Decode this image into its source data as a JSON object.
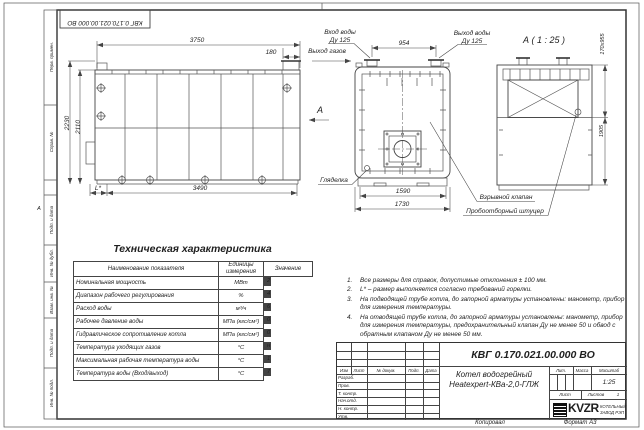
{
  "doc": {
    "number": "КВГ 0.170.021.00.000 ВО",
    "number_top": "КВГ 0.170.021.00.000 ВО",
    "name_line1": "Котел водогрейный",
    "name_line2": "Heatexpert-КВа-2,0-ГЛЖ",
    "scale_value": "1:25",
    "sheets_value": "1",
    "copied_label": "Копировал",
    "format_label": "Формат А3"
  },
  "frame": {
    "zone": "А",
    "left_labels": [
      "Перв. примен.",
      "Справ. №",
      "Подп. и дата",
      "Инв. № дубл.",
      "Взам. инв. №",
      "Подп. и дата",
      "Инв. № подл."
    ]
  },
  "views": {
    "view_arrow": "А",
    "side": {
      "dims": {
        "top": "3750",
        "offset": "180",
        "h1": "2230",
        "h2": "2110",
        "bottom": "3490",
        "l": "L*"
      }
    },
    "front": {
      "dims": {
        "nozzles": "954",
        "base": "1590",
        "full": "1730"
      },
      "labels": {
        "in1": "Вход воды",
        "in2": "Ду 125",
        "out1": "Выход воды",
        "out2": "Ду 125",
        "gas": "Выход газов",
        "sight": "Гляделка",
        "valve": "Взрывной клапан",
        "sampler": "Пробоотборный штуцер"
      }
    },
    "section": {
      "title": "А ( 1 : 25 )",
      "dims": {
        "opening": "170х955",
        "height": "1905"
      }
    }
  },
  "table": {
    "title": "Техническая характеристика",
    "headers": [
      "Наименование показателя",
      "Единицы измерения",
      "Значение"
    ],
    "rows": [
      {
        "name": "Номинальная мощность",
        "unit": "МВт",
        "value": "2,0"
      },
      {
        "name": "Диапазон рабочего регулирования",
        "unit": "%",
        "value": "40-100"
      },
      {
        "name": "Расход воды",
        "unit": "м³/ч",
        "value": "68"
      },
      {
        "name": "Рабочее давление воды",
        "unit": "МПа (кгс/см²)",
        "value": "0,3(3,0)-0,6(6,0)"
      },
      {
        "name": "Гидравлическое сопротивление котла",
        "unit": "МПа (кгс/см²)",
        "value": "0,07(0,7)"
      },
      {
        "name": "Температура уходящих газов",
        "unit": "°С",
        "value": "не более 220"
      },
      {
        "name": "Максимальная рабочая температура воды",
        "unit": "°С",
        "value": "115"
      },
      {
        "name": "Температура воды (Вход/выход)",
        "unit": "°С",
        "value": "70/95"
      }
    ]
  },
  "notes": {
    "items": [
      {
        "num": "1.",
        "text": "Все размеры для справок, допустимые отклонения ± 100 мм."
      },
      {
        "num": "2.",
        "text": "L* – размер выполняется согласно требований горелки."
      },
      {
        "num": "3.",
        "text": "На подводящей трубе котла, до запорной арматуры установлены: манометр, прибор для измерения температуры."
      },
      {
        "num": "4.",
        "text": "На отводящей трубе котла, до запорной арматуры установлены: манометр, прибор для измерения температуры, предохранительный клапан Ду не менее 50 и обвод с обратным клапаном Ду не менее 50 мм."
      }
    ]
  },
  "titleblock": {
    "cols": [
      "Изм",
      "Лист",
      "№ докум.",
      "Подп.",
      "Дата"
    ],
    "rows": [
      "Разраб.",
      "Пров.",
      "Т. контр.",
      "Нач.отд.",
      "Н. контр.",
      "Утв."
    ],
    "lit_label": "Лит.",
    "mass_label": "Масса",
    "scale_label": "Масштаб",
    "sheet_label": "Лист",
    "sheets_label": "Листов",
    "logo_text": "KVZR",
    "company_line1": "КОТЕЛЬНЫЙ",
    "company_line2": "ЗАВОД РЭП"
  }
}
